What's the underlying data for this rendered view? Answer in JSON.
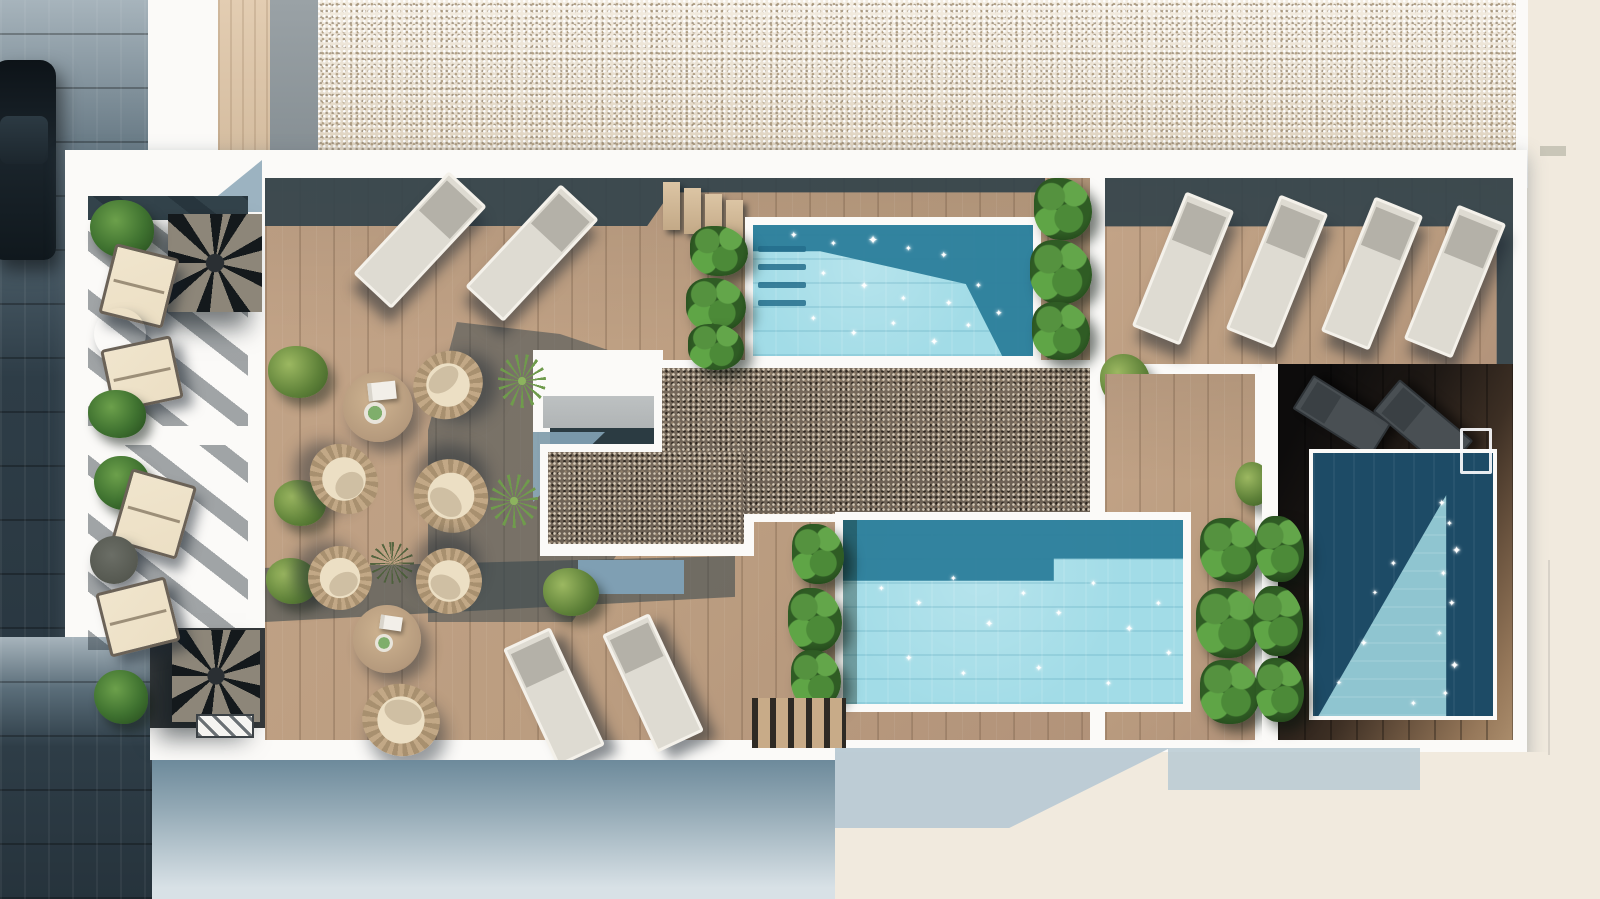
{
  "meta": {
    "description": "Aerial 3D rendering of a residential rooftop terrace with three swimming pools, wooden decks, sun loungers, round wicker seating groups, private balconies with spiral staircases, gravel beds and a street with a parked car on the left",
    "width": 1600,
    "height": 899
  },
  "palette": {
    "wood": "#bb9d80",
    "wood_pale": "#cdb497",
    "shadow": "#33434b",
    "white": "#fbfaf8",
    "cream": "#f1eade",
    "blue_shadow": "#b9cad4",
    "pebble": "#e7decf",
    "gravel": "#6b6054",
    "water_light": "#a2dce7",
    "water_dark": "#2d7f9b",
    "water_deep": "#1d4b66",
    "water_tri": "#8fc5d0",
    "street_top": "#a7b4bc",
    "street_dark": "#2e3d47",
    "green_bush": "#5d8038",
    "green_leaf": "#55923f",
    "wicker": "#c2a886",
    "cushion": "#ecdfc4",
    "table_wood": "#b59a7d",
    "table_grey": "#a09c91",
    "lounger_body": "#dedbd2",
    "lounger_head": "#b4b1a8",
    "lounger_dark_c": "#494f53",
    "facade_top": "#6d8a9b",
    "facade_bottom": "#d8e1e6"
  },
  "icons": {
    "sparkle": "✦"
  },
  "objects": [
    {
      "name": "street-pavement",
      "cls": "street",
      "x": 0,
      "y": 0,
      "w": 152,
      "h": 899
    },
    {
      "name": "parked-car",
      "cls": "car",
      "x": -8,
      "y": 60,
      "w": 64,
      "h": 200
    },
    {
      "name": "exterior-cream-right",
      "cls": "cream",
      "x": 1520,
      "y": 0,
      "w": 80,
      "h": 899
    },
    {
      "name": "top-parapet-white",
      "cls": "whiteband",
      "x": 148,
      "y": 0,
      "w": 1380,
      "h": 188
    },
    {
      "name": "top-wood-walkway",
      "cls": "woodstrip",
      "x": 218,
      "y": 0,
      "w": 52,
      "h": 170
    },
    {
      "name": "top-grey-walkway",
      "cls": "greystrip",
      "x": 270,
      "y": 0,
      "w": 48,
      "h": 170
    },
    {
      "name": "pebble-roof",
      "cls": "pebbles",
      "x": 318,
      "y": 0,
      "w": 1198,
      "h": 158
    },
    {
      "name": "roof-grey-mark",
      "cls": "greymark",
      "x": 1540,
      "y": 146,
      "w": 26,
      "h": 10
    },
    {
      "name": "roof-slab",
      "cls": "slab",
      "x": 65,
      "y": 150,
      "w": 1462,
      "h": 610
    },
    {
      "name": "street-corner-bottom-left",
      "cls": "street",
      "x": 0,
      "y": 637,
      "w": 150,
      "h": 262
    },
    {
      "name": "corner-shadow-wedge",
      "cls": "tri-blue",
      "x": 198,
      "y": 160,
      "w": 64,
      "h": 52
    },
    {
      "name": "balcony1-deck",
      "cls": "deckpale",
      "x": 88,
      "y": 196,
      "w": 160,
      "h": 230
    },
    {
      "name": "balcony1-shade-band",
      "cls": "darksolid",
      "x": 88,
      "y": 196,
      "w": 160,
      "h": 24
    },
    {
      "name": "balcony1-shadow-streaks",
      "cls": "streaks",
      "x": 88,
      "y": 196,
      "w": 160,
      "h": 230
    },
    {
      "name": "balcony1-spiral-stair",
      "cls": "spiral",
      "x": 168,
      "y": 214,
      "w": 94,
      "h": 98
    },
    {
      "name": "balcony1-plant-top",
      "cls": "leafplant",
      "x": 90,
      "y": 200,
      "w": 64,
      "h": 58
    },
    {
      "name": "balcony1-lounge-chair-1",
      "cls": "creamchair",
      "x": 106,
      "y": 250,
      "w": 66,
      "h": 72,
      "rot": 14
    },
    {
      "name": "balcony1-side-table",
      "cls": "greytable",
      "x": 94,
      "y": 308,
      "w": 52,
      "h": 52
    },
    {
      "name": "balcony1-lounge-chair-2",
      "cls": "creamchair",
      "x": 106,
      "y": 342,
      "w": 72,
      "h": 64,
      "rot": -12
    },
    {
      "name": "balcony1-plant-bottom",
      "cls": "leafplant",
      "x": 88,
      "y": 390,
      "w": 58,
      "h": 48
    },
    {
      "name": "balcony2-deck",
      "cls": "deckpale",
      "x": 88,
      "y": 445,
      "w": 160,
      "h": 205
    },
    {
      "name": "balcony2-shadow-streaks",
      "cls": "streaks",
      "x": 88,
      "y": 445,
      "w": 160,
      "h": 205
    },
    {
      "name": "stair-alcove-dark",
      "cls": "alcove",
      "x": 150,
      "y": 628,
      "w": 118,
      "h": 100
    },
    {
      "name": "balcony2-spiral-stair",
      "cls": "spiral",
      "x": 172,
      "y": 630,
      "w": 88,
      "h": 92
    },
    {
      "name": "stair-hatch-grate",
      "cls": "hatch",
      "x": 196,
      "y": 714,
      "w": 58,
      "h": 24
    },
    {
      "name": "balcony2-plant-top",
      "cls": "leafplant",
      "x": 94,
      "y": 456,
      "w": 56,
      "h": 54
    },
    {
      "name": "balcony2-lounge-chair-1",
      "cls": "creamchair",
      "x": 120,
      "y": 476,
      "w": 68,
      "h": 76,
      "rot": 16
    },
    {
      "name": "balcony2-side-table",
      "cls": "darktable",
      "x": 90,
      "y": 536,
      "w": 48,
      "h": 48
    },
    {
      "name": "balcony2-lounge-chair-2",
      "cls": "creamchair",
      "x": 102,
      "y": 584,
      "w": 72,
      "h": 66,
      "rot": -14
    },
    {
      "name": "balcony2-plant-bottom",
      "cls": "leafplant",
      "x": 94,
      "y": 670,
      "w": 54,
      "h": 54
    },
    {
      "name": "main-terrace-deck",
      "cls": "deck",
      "x": 265,
      "y": 178,
      "w": 825,
      "h": 562
    },
    {
      "name": "terrace-top-shadow",
      "cls": "shadow s1",
      "x": 265,
      "y": 178,
      "w": 780,
      "h": 48
    },
    {
      "name": "stair-tread-1",
      "cls": "tread",
      "x": 663,
      "y": 182,
      "w": 17,
      "h": 48
    },
    {
      "name": "stair-tread-2",
      "cls": "tread",
      "x": 684,
      "y": 188,
      "w": 17,
      "h": 46
    },
    {
      "name": "stair-tread-3",
      "cls": "tread",
      "x": 705,
      "y": 194,
      "w": 17,
      "h": 44
    },
    {
      "name": "stair-tread-4",
      "cls": "tread",
      "x": 726,
      "y": 200,
      "w": 17,
      "h": 42
    },
    {
      "name": "terrace-central-shadow",
      "cls": "shadow s2",
      "x": 428,
      "y": 322,
      "w": 240,
      "h": 300
    },
    {
      "name": "terrace-bottom-shadow",
      "cls": "shadow s3",
      "x": 265,
      "y": 556,
      "w": 470,
      "h": 66
    },
    {
      "name": "skylight-structure-white",
      "cls": "white",
      "x": 533,
      "y": 350,
      "w": 130,
      "h": 82
    },
    {
      "name": "skylight-grey-slab",
      "cls": "slabgrey",
      "x": 543,
      "y": 396,
      "w": 118,
      "h": 32
    },
    {
      "name": "skylight-shade-strip",
      "cls": "teal",
      "x": 550,
      "y": 428,
      "w": 112,
      "h": 16
    },
    {
      "name": "skylight-blue-shadow",
      "cls": "tri-blue2",
      "x": 533,
      "y": 432,
      "w": 72,
      "h": 70
    },
    {
      "name": "gravel-border-main",
      "cls": "white",
      "x": 654,
      "y": 360,
      "w": 446,
      "h": 162
    },
    {
      "name": "gravel-border-ext",
      "cls": "white",
      "x": 540,
      "y": 444,
      "w": 214,
      "h": 112
    },
    {
      "name": "gravel-bed-main",
      "cls": "gravel",
      "x": 662,
      "y": 368,
      "w": 430,
      "h": 146
    },
    {
      "name": "gravel-bed-ext",
      "cls": "gravel",
      "x": 548,
      "y": 452,
      "w": 196,
      "h": 92
    },
    {
      "name": "walkway-blue-shadow",
      "cls": "bluerect",
      "x": 578,
      "y": 560,
      "w": 106,
      "h": 34
    },
    {
      "name": "divider-wall-white",
      "cls": "white",
      "x": 1090,
      "y": 158,
      "w": 16,
      "h": 356
    },
    {
      "name": "pool1-rim",
      "cls": "rim",
      "x": 745,
      "y": 217,
      "w": 296,
      "h": 147
    },
    {
      "name": "pool1-water",
      "cls": "water",
      "x": 753,
      "y": 225,
      "w": 280,
      "h": 131
    },
    {
      "name": "pool1-shadow-overlay",
      "cls": "waterdark p1dark",
      "x": 753,
      "y": 225,
      "w": 280,
      "h": 131
    },
    {
      "name": "pool1-step-1",
      "cls": "poolstep",
      "x": 758,
      "y": 246,
      "w": 48,
      "h": 6
    },
    {
      "name": "pool1-step-2",
      "cls": "poolstep",
      "x": 758,
      "y": 264,
      "w": 48,
      "h": 6
    },
    {
      "name": "pool1-step-3",
      "cls": "poolstep",
      "x": 758,
      "y": 282,
      "w": 48,
      "h": 6
    },
    {
      "name": "pool1-step-4",
      "cls": "poolstep",
      "x": 758,
      "y": 300,
      "w": 48,
      "h": 6
    },
    {
      "name": "pool1-plants-left-1",
      "cls": "plantcol",
      "x": 690,
      "y": 226,
      "w": 58,
      "h": 50
    },
    {
      "name": "pool1-plants-left-2",
      "cls": "plantcol",
      "x": 686,
      "y": 278,
      "w": 60,
      "h": 54
    },
    {
      "name": "pool1-plants-left-3",
      "cls": "plantcol",
      "x": 688,
      "y": 324,
      "w": 56,
      "h": 46
    },
    {
      "name": "pool1-plants-right-1",
      "cls": "plantcol",
      "x": 1034,
      "y": 178,
      "w": 58,
      "h": 62
    },
    {
      "name": "pool1-plants-right-2",
      "cls": "plantcol",
      "x": 1030,
      "y": 240,
      "w": 62,
      "h": 64
    },
    {
      "name": "pool1-plants-right-3",
      "cls": "plantcol",
      "x": 1032,
      "y": 302,
      "w": 58,
      "h": 58
    },
    {
      "name": "right-deck",
      "cls": "deck",
      "x": 1105,
      "y": 178,
      "w": 408,
      "h": 186
    },
    {
      "name": "right-deck-shadow",
      "cls": "shadow rd-shadow",
      "x": 1105,
      "y": 178,
      "w": 408,
      "h": 186
    },
    {
      "name": "right-deck-bush",
      "cls": "bush",
      "x": 1100,
      "y": 354,
      "w": 50,
      "h": 52
    },
    {
      "name": "right-lounger-1",
      "cls": "lounger",
      "x": 1157,
      "y": 196,
      "w": 52,
      "h": 145,
      "rot": 22
    },
    {
      "name": "right-lounger-2",
      "cls": "lounger",
      "x": 1251,
      "y": 199,
      "w": 52,
      "h": 145,
      "rot": 22
    },
    {
      "name": "right-lounger-3",
      "cls": "lounger",
      "x": 1346,
      "y": 201,
      "w": 52,
      "h": 145,
      "rot": 22
    },
    {
      "name": "right-lounger-4",
      "cls": "lounger",
      "x": 1429,
      "y": 209,
      "w": 52,
      "h": 145,
      "rot": 22
    },
    {
      "name": "mid-lower-deck",
      "cls": "deck",
      "x": 1105,
      "y": 374,
      "w": 150,
      "h": 366
    },
    {
      "name": "mid-bush",
      "cls": "bush",
      "x": 1235,
      "y": 462,
      "w": 36,
      "h": 44
    },
    {
      "name": "mid-plants-1",
      "cls": "plantcol",
      "x": 1200,
      "y": 518,
      "w": 60,
      "h": 64
    },
    {
      "name": "mid-plants-2",
      "cls": "plantcol",
      "x": 1196,
      "y": 588,
      "w": 64,
      "h": 70
    },
    {
      "name": "mid-plants-3",
      "cls": "plantcol",
      "x": 1200,
      "y": 660,
      "w": 60,
      "h": 64
    },
    {
      "name": "pool3-wall-white",
      "cls": "white",
      "x": 1262,
      "y": 364,
      "w": 16,
      "h": 376
    },
    {
      "name": "pool3-dark-deck",
      "cls": "zone-rp",
      "x": 1278,
      "y": 364,
      "w": 235,
      "h": 376
    },
    {
      "name": "pool3-dark-lounger-1",
      "cls": "lounger-dark",
      "x": 1322,
      "y": 370,
      "w": 40,
      "h": 92,
      "rot": -58
    },
    {
      "name": "pool3-dark-lounger-2",
      "cls": "lounger-dark",
      "x": 1402,
      "y": 378,
      "w": 42,
      "h": 96,
      "rot": -50
    },
    {
      "name": "pool3-rim",
      "cls": "rim",
      "x": 1309,
      "y": 449,
      "w": 188,
      "h": 271
    },
    {
      "name": "pool3-water",
      "cls": "waterdeep",
      "x": 1313,
      "y": 453,
      "w": 180,
      "h": 263
    },
    {
      "name": "pool3-sunlight-triangle",
      "cls": "watertri",
      "x": 1313,
      "y": 453,
      "w": 180,
      "h": 263
    },
    {
      "name": "pool3-ladder",
      "cls": "ladder",
      "x": 1460,
      "y": 428,
      "w": 32,
      "h": 46
    },
    {
      "name": "pool3-plants-1",
      "cls": "plantcol",
      "x": 1256,
      "y": 516,
      "w": 48,
      "h": 66
    },
    {
      "name": "pool3-plants-2",
      "cls": "plantcol",
      "x": 1253,
      "y": 586,
      "w": 50,
      "h": 70
    },
    {
      "name": "pool3-plants-3",
      "cls": "plantcol",
      "x": 1256,
      "y": 658,
      "w": 48,
      "h": 64
    },
    {
      "name": "pool2-rim",
      "cls": "rim",
      "x": 835,
      "y": 512,
      "w": 356,
      "h": 200
    },
    {
      "name": "pool2-water",
      "cls": "water",
      "x": 843,
      "y": 520,
      "w": 340,
      "h": 184
    },
    {
      "name": "pool2-shadow-overlay",
      "cls": "waterdark p2dark",
      "x": 843,
      "y": 520,
      "w": 340,
      "h": 184
    },
    {
      "name": "pool2-plant-shade",
      "cls": "plantshade",
      "x": 843,
      "y": 520,
      "w": 14,
      "h": 184
    },
    {
      "name": "pool2-plants-1",
      "cls": "plantcol",
      "x": 792,
      "y": 524,
      "w": 52,
      "h": 60
    },
    {
      "name": "pool2-plants-2",
      "cls": "plantcol",
      "x": 788,
      "y": 588,
      "w": 54,
      "h": 64
    },
    {
      "name": "pool2-plants-3",
      "cls": "plantcol",
      "x": 791,
      "y": 650,
      "w": 50,
      "h": 58
    },
    {
      "name": "pool2-slat-deck",
      "cls": "slats",
      "x": 752,
      "y": 698,
      "w": 94,
      "h": 50
    },
    {
      "name": "seating1-bush-1",
      "cls": "bush",
      "x": 268,
      "y": 346,
      "w": 60,
      "h": 52
    },
    {
      "name": "seating1-bush-2",
      "cls": "bush",
      "x": 274,
      "y": 480,
      "w": 52,
      "h": 46
    },
    {
      "name": "seating1-table",
      "cls": "woodtable",
      "x": 343,
      "y": 372,
      "w": 70,
      "h": 70
    },
    {
      "name": "seating1-book",
      "cls": "book",
      "x": 368,
      "y": 382,
      "w": 28,
      "h": 18,
      "rot": -6
    },
    {
      "name": "seating1-plant-pot",
      "cls": "pot",
      "x": 364,
      "y": 402,
      "w": 22,
      "h": 22
    },
    {
      "name": "seating1-wicker-chair-1",
      "cls": "wicker",
      "x": 412,
      "y": 352,
      "w": 72,
      "h": 66,
      "rot": -40
    },
    {
      "name": "seating1-wicker-chair-2",
      "cls": "wicker",
      "x": 312,
      "y": 442,
      "w": 64,
      "h": 74,
      "rot": 140
    },
    {
      "name": "seating1-wicker-chair-3",
      "cls": "wicker",
      "x": 413,
      "y": 460,
      "w": 76,
      "h": 72,
      "rot": -140
    },
    {
      "name": "yucca-plant-1",
      "cls": "yucca",
      "x": 498,
      "y": 354,
      "w": 48,
      "h": 54
    },
    {
      "name": "yucca-plant-2",
      "cls": "yucca",
      "x": 490,
      "y": 474,
      "w": 48,
      "h": 54
    },
    {
      "name": "seating2-bush-1",
      "cls": "bush",
      "x": 266,
      "y": 558,
      "w": 52,
      "h": 46
    },
    {
      "name": "seating2-bush-2",
      "cls": "bush",
      "x": 543,
      "y": 568,
      "w": 56,
      "h": 48
    },
    {
      "name": "seating2-palm",
      "cls": "palmdark",
      "x": 370,
      "y": 542,
      "w": 44,
      "h": 42
    },
    {
      "name": "seating2-table",
      "cls": "woodtable",
      "x": 353,
      "y": 605,
      "w": 68,
      "h": 68
    },
    {
      "name": "seating2-book",
      "cls": "book",
      "x": 380,
      "y": 616,
      "w": 22,
      "h": 14,
      "rot": 8
    },
    {
      "name": "seating2-plant-pot",
      "cls": "pot",
      "x": 375,
      "y": 634,
      "w": 18,
      "h": 18
    },
    {
      "name": "seating2-wicker-chair-1",
      "cls": "wicker",
      "x": 308,
      "y": 546,
      "w": 64,
      "h": 64,
      "rot": 150
    },
    {
      "name": "seating2-wicker-chair-2",
      "cls": "wicker",
      "x": 416,
      "y": 548,
      "w": 66,
      "h": 66,
      "rot": -150
    },
    {
      "name": "seating2-wicker-chair-3",
      "cls": "wicker",
      "x": 362,
      "y": 684,
      "w": 78,
      "h": 72,
      "rot": 15
    },
    {
      "name": "bottom-lounger-1",
      "cls": "lounger",
      "x": 528,
      "y": 632,
      "w": 52,
      "h": 130,
      "rot": -25
    },
    {
      "name": "bottom-lounger-2",
      "cls": "lounger",
      "x": 627,
      "y": 618,
      "w": 52,
      "h": 130,
      "rot": -25
    },
    {
      "name": "topleft-lounger-1",
      "cls": "lounger",
      "x": 394,
      "y": 170,
      "w": 52,
      "h": 140,
      "rot": 43
    },
    {
      "name": "topleft-lounger-2",
      "cls": "lounger",
      "x": 506,
      "y": 183,
      "w": 52,
      "h": 140,
      "rot": 43
    },
    {
      "name": "facade-bottom-left",
      "cls": "facadeL",
      "x": 152,
      "y": 760,
      "w": 683,
      "h": 139
    },
    {
      "name": "facade-bottom-right",
      "cls": "facadeR",
      "x": 835,
      "y": 752,
      "w": 765,
      "h": 147
    },
    {
      "name": "facade-shadow-triangle",
      "cls": "fshadow1",
      "x": 835,
      "y": 748,
      "w": 335,
      "h": 80
    },
    {
      "name": "facade-shadow-step",
      "cls": "fshadow2",
      "x": 1168,
      "y": 748,
      "w": 252,
      "h": 42
    },
    {
      "name": "facade-right-line",
      "cls": "vline",
      "x": 1548,
      "y": 560,
      "w": 2,
      "h": 195
    }
  ],
  "sparkles": {
    "pool1": [
      [
        790,
        232,
        9
      ],
      [
        830,
        240,
        8
      ],
      [
        868,
        234,
        12
      ],
      [
        905,
        245,
        8
      ],
      [
        940,
        252,
        9
      ],
      [
        820,
        270,
        8
      ],
      [
        860,
        282,
        10
      ],
      [
        900,
        295,
        8
      ],
      [
        945,
        300,
        9
      ],
      [
        975,
        282,
        8
      ],
      [
        810,
        315,
        8
      ],
      [
        850,
        330,
        9
      ],
      [
        890,
        320,
        8
      ],
      [
        930,
        338,
        10
      ],
      [
        965,
        322,
        8
      ],
      [
        995,
        310,
        9
      ]
    ],
    "pool2": [
      [
        878,
        585,
        8
      ],
      [
        915,
        600,
        9
      ],
      [
        950,
        575,
        8
      ],
      [
        985,
        620,
        10
      ],
      [
        1020,
        590,
        8
      ],
      [
        1055,
        610,
        9
      ],
      [
        1090,
        580,
        8
      ],
      [
        1125,
        625,
        10
      ],
      [
        1155,
        600,
        8
      ],
      [
        905,
        655,
        9
      ],
      [
        960,
        670,
        8
      ],
      [
        1035,
        665,
        9
      ],
      [
        1105,
        680,
        8
      ],
      [
        1165,
        650,
        9
      ]
    ],
    "pool3": [
      [
        1438,
        500,
        9
      ],
      [
        1446,
        520,
        8
      ],
      [
        1452,
        545,
        11
      ],
      [
        1440,
        570,
        8
      ],
      [
        1448,
        600,
        9
      ],
      [
        1436,
        630,
        8
      ],
      [
        1450,
        660,
        11
      ],
      [
        1442,
        690,
        8
      ],
      [
        1390,
        560,
        8
      ],
      [
        1360,
        640,
        9
      ],
      [
        1410,
        700,
        8
      ],
      [
        1336,
        680,
        7
      ],
      [
        1372,
        590,
        7
      ]
    ]
  }
}
